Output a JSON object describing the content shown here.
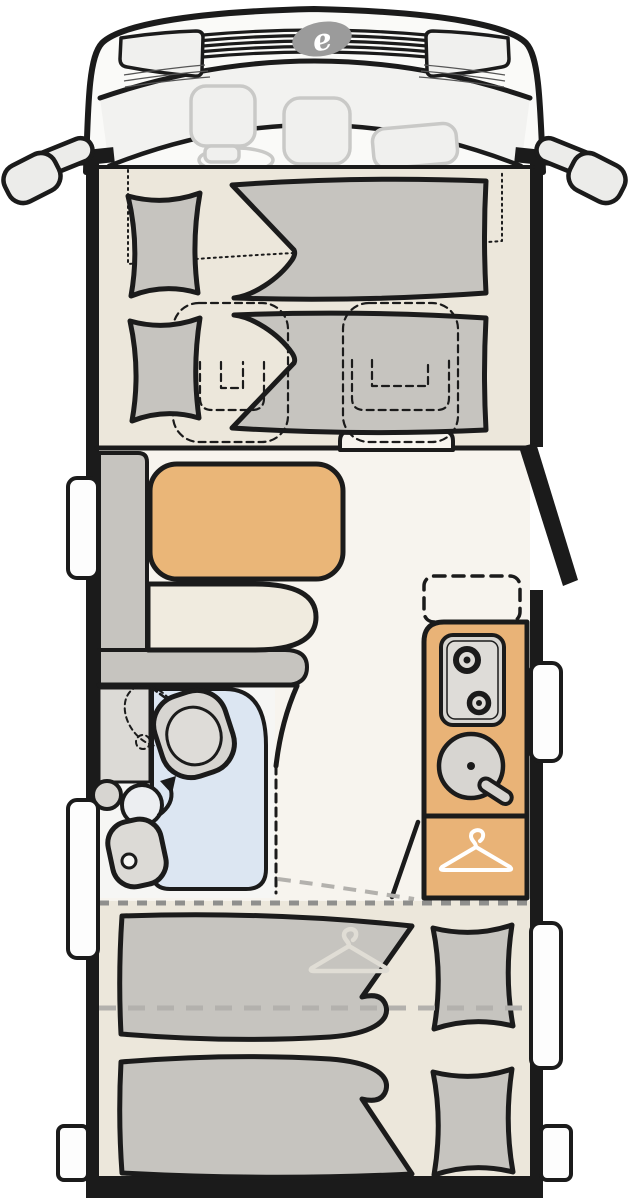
{
  "logo": {
    "glyph": "e"
  },
  "colors": {
    "page": "#FFFFFF",
    "outline": "#1B1B1B",
    "body": "#FAFAF8",
    "glass": "#F2F2F0",
    "seat_line": "#C9C9C7",
    "seat_fill": "#F0F0EE",
    "mirror": "#ECECEA",
    "logo": "#9B9B9B",
    "floor_bedroom": "#ECE7DB",
    "floor_living": "#F7F4EE",
    "furniture": "#C6C4BF",
    "cushion": "#F0EBDF",
    "table": "#EAB678",
    "kitchen": "#E9B377",
    "appliance": "#D7D5D1",
    "appliance_inner": "#DEDCD8",
    "shower": "#DCE6F2",
    "bath_floor": "#F6F6F4",
    "vanity": "#DCDAD6",
    "pivot": "#ECEEF1",
    "dash_dark": "#8F8F8D",
    "dash_light": "#B3B1AD",
    "window": "#FDFDFD",
    "white": "#FFFFFF",
    "hanger_ghost": "#E0DDD5"
  }
}
